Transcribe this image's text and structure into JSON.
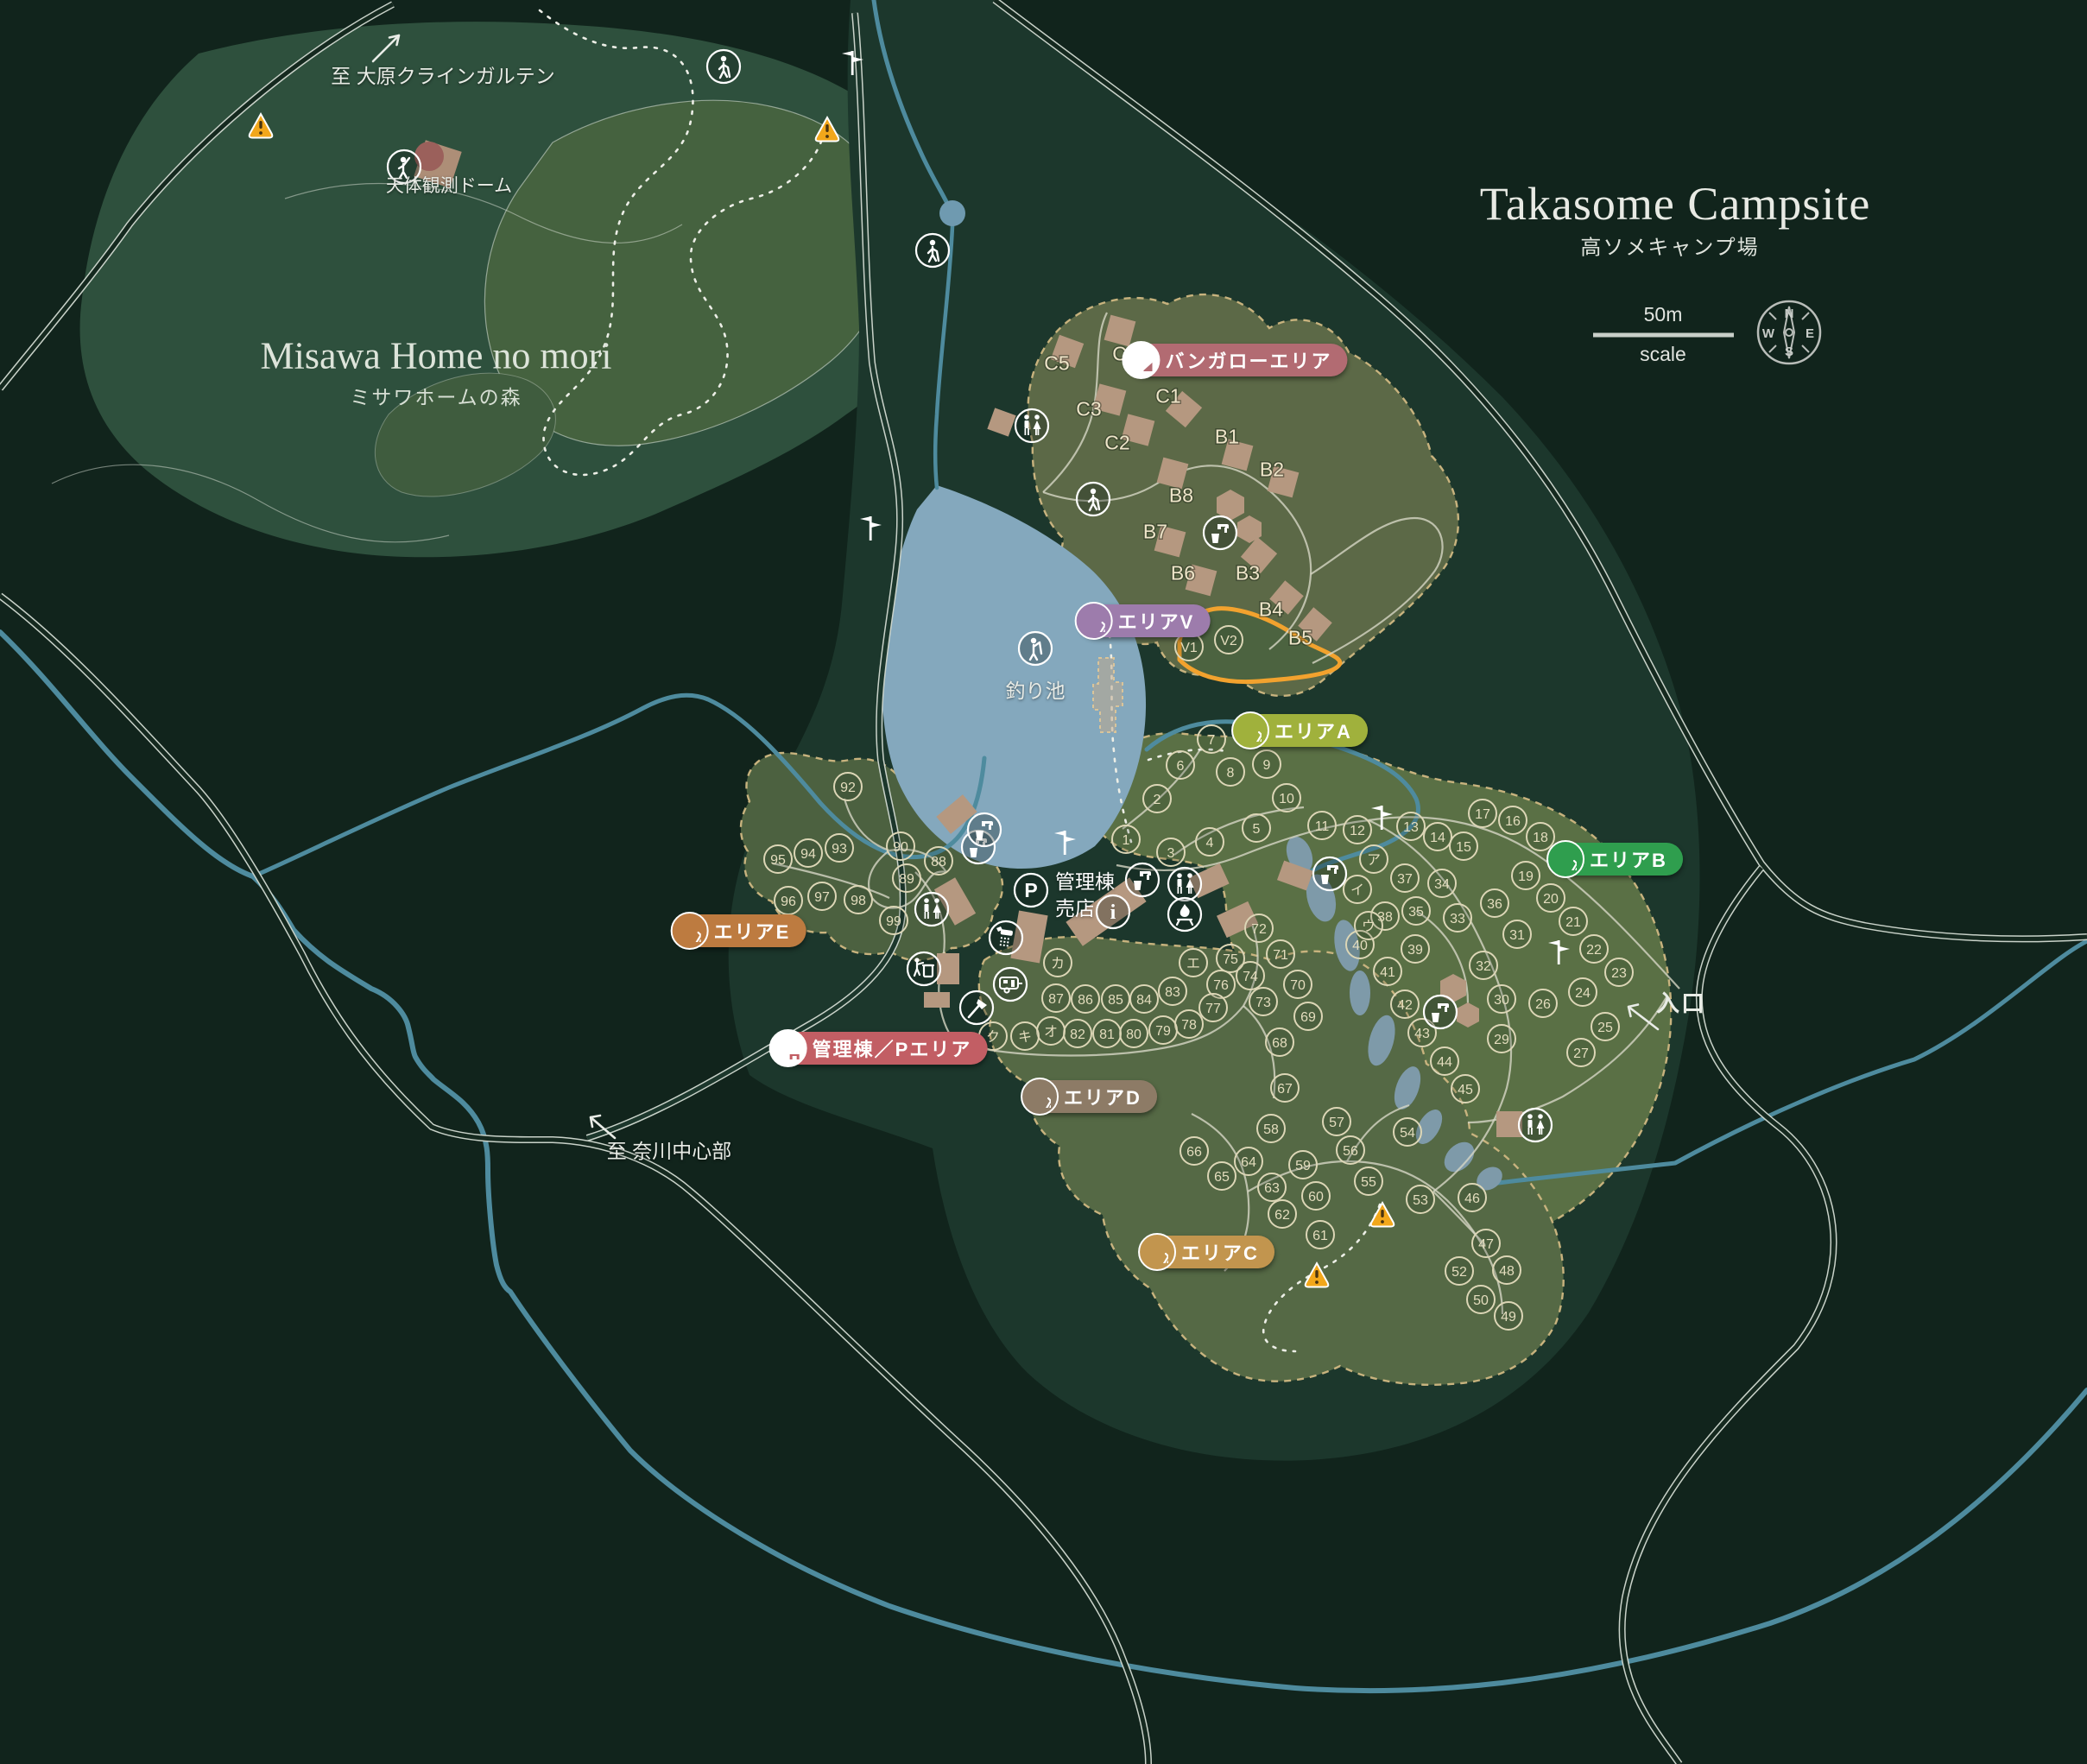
{
  "header": {
    "title_en": "Takasome Campsite",
    "title_ja": "高ソメキャンプ場"
  },
  "scale_bar": {
    "distance": "50m",
    "caption": "scale"
  },
  "compass": {
    "n": "N",
    "e": "E",
    "s": "S",
    "w": "W"
  },
  "labels": {
    "forest_title": "Misawa Home no mori",
    "forest_subtitle": "ミサワホームの森",
    "observatory": "天体観測ドーム",
    "pond": "釣り池",
    "office_line1": "管理棟",
    "office_line2": "売店",
    "entrance": "入口",
    "to_ohara": "至 大原クラインガルテン",
    "to_nagawa": "至 奈川中心部"
  },
  "badges": [
    {
      "id": "bungalow-area",
      "label": "バンガローエリア",
      "color": "#b26b72",
      "icon": "house"
    },
    {
      "id": "area-v",
      "label": "エリアV",
      "color": "#9d7cac",
      "icon": "tent"
    },
    {
      "id": "area-a",
      "label": "エリアA",
      "color": "#a0b13c",
      "icon": "tent"
    },
    {
      "id": "area-b",
      "label": "エリアB",
      "color": "#2f9e4e",
      "icon": "tent"
    },
    {
      "id": "area-e",
      "label": "エリアE",
      "color": "#bd7b40",
      "icon": "tent"
    },
    {
      "id": "mgmt-p-area",
      "label": "管理棟／Pエリア",
      "color": "#c25e64",
      "icon": "car"
    },
    {
      "id": "area-d",
      "label": "エリアD",
      "color": "#8d7b66",
      "icon": "tent"
    },
    {
      "id": "area-c",
      "label": "エリアC",
      "color": "#c2954e",
      "icon": "tent"
    }
  ],
  "map": {
    "sites": [
      [
        1,
        1304,
        972
      ],
      [
        2,
        1340,
        925
      ],
      [
        3,
        1356,
        987
      ],
      [
        4,
        1401,
        975
      ],
      [
        5,
        1455,
        959
      ],
      [
        6,
        1367,
        886
      ],
      [
        7,
        1403,
        856
      ],
      [
        8,
        1425,
        894
      ],
      [
        9,
        1467,
        885
      ],
      [
        10,
        1490,
        924
      ],
      [
        11,
        1531,
        956
      ],
      [
        12,
        1572,
        961
      ],
      [
        13,
        1634,
        957
      ],
      [
        14,
        1665,
        969
      ],
      [
        15,
        1695,
        980
      ],
      [
        16,
        1752,
        950
      ],
      [
        17,
        1717,
        942
      ],
      [
        18,
        1784,
        969
      ],
      [
        19,
        1767,
        1014
      ],
      [
        20,
        1796,
        1040
      ],
      [
        21,
        1822,
        1067
      ],
      [
        22,
        1846,
        1099
      ],
      [
        23,
        1875,
        1126
      ],
      [
        24,
        1833,
        1149
      ],
      [
        25,
        1859,
        1189
      ],
      [
        26,
        1787,
        1162
      ],
      [
        27,
        1831,
        1219
      ],
      [
        29,
        1739,
        1203
      ],
      [
        30,
        1739,
        1157
      ],
      [
        31,
        1757,
        1082
      ],
      [
        32,
        1718,
        1118
      ],
      [
        33,
        1688,
        1063
      ],
      [
        34,
        1670,
        1023
      ],
      [
        35,
        1640,
        1055
      ],
      [
        36,
        1731,
        1046
      ],
      [
        37,
        1627,
        1017
      ],
      [
        38,
        1604,
        1061
      ],
      [
        39,
        1639,
        1099
      ],
      [
        40,
        1575,
        1094
      ],
      [
        41,
        1607,
        1125
      ],
      [
        42,
        1627,
        1163
      ],
      [
        43,
        1647,
        1196
      ],
      [
        44,
        1673,
        1229
      ],
      [
        45,
        1697,
        1261
      ],
      [
        46,
        1705,
        1387
      ],
      [
        47,
        1721,
        1440
      ],
      [
        48,
        1745,
        1471
      ],
      [
        49,
        1747,
        1524
      ],
      [
        50,
        1715,
        1505
      ],
      [
        52,
        1690,
        1472
      ],
      [
        53,
        1645,
        1389
      ],
      [
        54,
        1630,
        1311
      ],
      [
        55,
        1585,
        1368
      ],
      [
        56,
        1564,
        1332
      ],
      [
        57,
        1548,
        1299
      ],
      [
        58,
        1472,
        1307
      ],
      [
        59,
        1509,
        1349
      ],
      [
        60,
        1524,
        1385
      ],
      [
        61,
        1529,
        1430
      ],
      [
        62,
        1485,
        1406
      ],
      [
        63,
        1473,
        1375
      ],
      [
        64,
        1446,
        1345
      ],
      [
        65,
        1415,
        1362
      ],
      [
        66,
        1383,
        1333
      ],
      [
        67,
        1488,
        1260
      ],
      [
        68,
        1482,
        1207
      ],
      [
        69,
        1515,
        1177
      ],
      [
        70,
        1503,
        1140
      ],
      [
        71,
        1483,
        1105
      ],
      [
        72,
        1458,
        1075
      ],
      [
        73,
        1463,
        1160
      ],
      [
        74,
        1448,
        1130
      ],
      [
        75,
        1425,
        1110
      ],
      [
        76,
        1414,
        1140
      ],
      [
        77,
        1405,
        1167
      ],
      [
        78,
        1377,
        1186
      ],
      [
        79,
        1347,
        1193
      ],
      [
        80,
        1313,
        1197
      ],
      [
        81,
        1282,
        1197
      ],
      [
        82,
        1248,
        1197
      ],
      [
        83,
        1358,
        1148
      ],
      [
        84,
        1325,
        1157
      ],
      [
        85,
        1292,
        1157
      ],
      [
        86,
        1257,
        1157
      ],
      [
        87,
        1223,
        1156
      ],
      [
        88,
        1087,
        997
      ],
      [
        89,
        1050,
        1017
      ],
      [
        90,
        1043,
        980
      ],
      [
        92,
        982,
        911
      ],
      [
        93,
        972,
        982
      ],
      [
        94,
        936,
        988
      ],
      [
        95,
        901,
        995
      ],
      [
        96,
        913,
        1043
      ],
      [
        97,
        952,
        1038
      ],
      [
        98,
        994,
        1042
      ],
      [
        99,
        1035,
        1066
      ],
      [
        "ア",
        1591,
        995
      ],
      [
        "イ",
        1572,
        1030
      ],
      [
        "ウ",
        1585,
        1072
      ],
      [
        "エ",
        1382,
        1115
      ],
      [
        "カ",
        1225,
        1115
      ],
      [
        "オ",
        1217,
        1194
      ],
      [
        "キ",
        1187,
        1200
      ],
      [
        "ク",
        1150,
        1200
      ],
      [
        "V1",
        1377,
        749
      ],
      [
        "V2",
        1423,
        741
      ]
    ],
    "bungalow_sites": [
      [
        "C5",
        1224,
        420
      ],
      [
        "C4",
        1303,
        409
      ],
      [
        "C3",
        1261,
        473
      ],
      [
        "C2",
        1294,
        512
      ],
      [
        "C1",
        1353,
        458
      ],
      [
        "B1",
        1421,
        505
      ],
      [
        "B2",
        1473,
        543
      ],
      [
        "B8",
        1368,
        573
      ],
      [
        "B7",
        1338,
        615
      ],
      [
        "B6",
        1370,
        663
      ],
      [
        "B3",
        1445,
        663
      ],
      [
        "B4",
        1472,
        705
      ],
      [
        "B5",
        1506,
        738
      ]
    ],
    "icons": [
      [
        "hiker",
        838,
        77
      ],
      [
        "hiker",
        1080,
        290
      ],
      [
        "hiker",
        1266,
        578
      ],
      [
        "fishing",
        1199,
        751
      ],
      [
        "stargazer",
        468,
        193
      ],
      [
        "signpost",
        987,
        73
      ],
      [
        "signpost",
        1008,
        612
      ],
      [
        "signpost",
        1233,
        976
      ],
      [
        "signpost",
        1600,
        947
      ],
      [
        "signpost",
        1805,
        1103
      ],
      [
        "water-tap",
        1413,
        617
      ],
      [
        "water-tap",
        1133,
        981
      ],
      [
        "water-tap",
        1540,
        1012
      ],
      [
        "water-tap",
        1323,
        1019
      ],
      [
        "water-tap",
        1140,
        961
      ],
      [
        "water-tap",
        1668,
        1172
      ],
      [
        "toilet",
        1195,
        493
      ],
      [
        "toilet",
        1372,
        1024
      ],
      [
        "toilet",
        1079,
        1053
      ],
      [
        "toilet",
        1778,
        1303
      ],
      [
        "shower",
        1165,
        1086
      ],
      [
        "trash",
        1070,
        1122
      ],
      [
        "axe",
        1131,
        1167
      ],
      [
        "caravan",
        1170,
        1140
      ],
      [
        "fire",
        1372,
        1059
      ],
      [
        "parking",
        1194,
        1031
      ],
      [
        "info",
        1289,
        1056
      ],
      [
        "warning",
        302,
        146
      ],
      [
        "warning",
        958,
        150
      ],
      [
        "warning",
        1601,
        1407
      ],
      [
        "warning",
        1525,
        1477
      ]
    ]
  },
  "colors": {
    "background": "#11241c",
    "forest": "#2e503d",
    "forest_light": "#45623f",
    "terrain": "#1c372c",
    "camp_area": "#5a7045",
    "camp_area_dark": "#4c6140",
    "pond": "#84a8bd",
    "stream": "#4e8b9e",
    "swamp": "#7e9aa9",
    "road": "#c9d2c9",
    "area_border_dash": "#c8b37e",
    "v_area_outline": "#f2a22e",
    "warning": "#f2a71b",
    "building": "#b59880"
  }
}
